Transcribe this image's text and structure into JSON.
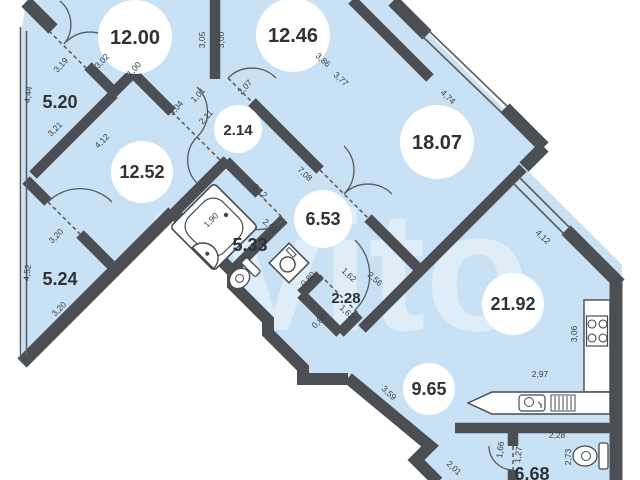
{
  "watermark": "Avito",
  "colors": {
    "floor": "#c9e1f4",
    "wall": "#4b4f54",
    "fixture_outline": "#45494e",
    "background": "#ffffff"
  },
  "rooms": [
    {
      "id": "room-12-00",
      "area": "12.00",
      "badge": "circle"
    },
    {
      "id": "room-12-46",
      "area": "12.46",
      "badge": "circle"
    },
    {
      "id": "room-18-07",
      "area": "18.07",
      "badge": "circle"
    },
    {
      "id": "room-2-14",
      "area": "2.14",
      "badge": "circle"
    },
    {
      "id": "room-12-52",
      "area": "12.52",
      "badge": "circle"
    },
    {
      "id": "room-6-53",
      "area": "6.53",
      "badge": "circle"
    },
    {
      "id": "room-21-92",
      "area": "21.92",
      "badge": "circle"
    },
    {
      "id": "room-9-65",
      "area": "9.65",
      "badge": "circle"
    },
    {
      "id": "loggia-5-20",
      "area": "5.20",
      "badge": "none"
    },
    {
      "id": "bath-5-33",
      "area": "5.33",
      "badge": "none"
    },
    {
      "id": "loggia-5-24",
      "area": "5.24",
      "badge": "none"
    },
    {
      "id": "closet-2-28",
      "area": "2.28",
      "badge": "none"
    },
    {
      "id": "wc-6-68",
      "area": "6.68",
      "badge": "none"
    }
  ],
  "dims": [
    "3,19",
    "3,02",
    "1,00",
    "4,44",
    "3,05",
    "3,00",
    "1,01",
    "3,04",
    "2,11",
    "2,07",
    "3,86",
    "3,77",
    "4,74",
    "7,08",
    "3,12",
    "2,91",
    "1,90",
    "3,21",
    "4,12",
    "3,20",
    "4,52",
    "3,20",
    "0,80",
    "1,62",
    "2,56",
    "1,62",
    "0,80",
    "3,59",
    "2,01",
    "4,12",
    "3,06",
    "2,97",
    "2,28",
    "2,73",
    "1,66",
    "1,27"
  ],
  "fixtures": [
    "bathtub",
    "bath-sink",
    "bath-toilet",
    "washing-machine",
    "kitchen-counter",
    "kitchen-stove",
    "kitchen-sink",
    "dish-rack",
    "wc-toilet"
  ]
}
